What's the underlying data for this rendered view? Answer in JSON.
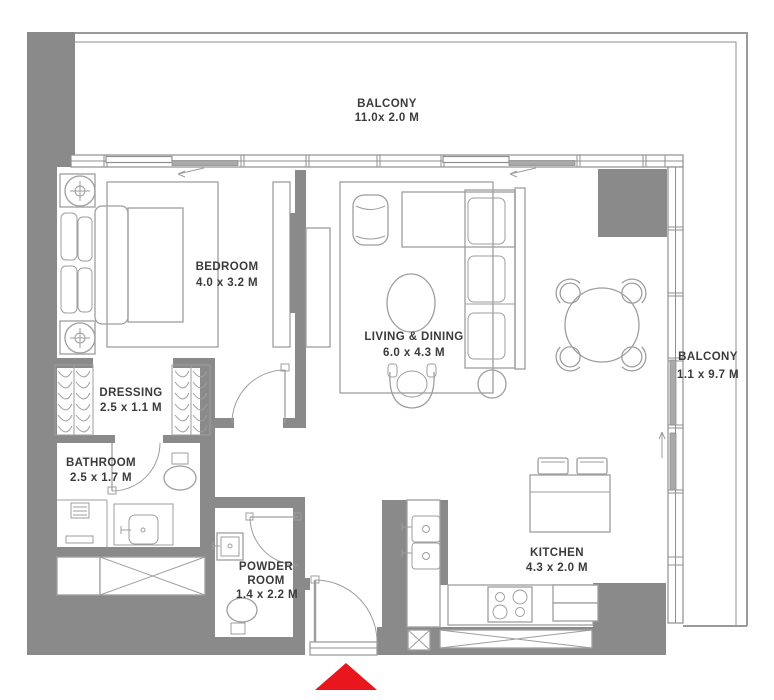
{
  "plan": {
    "type": "apartment-floor-plan",
    "rooms": {
      "balcony_top": {
        "name": "BALCONY",
        "dims": "11.0x 2.0 M"
      },
      "bedroom": {
        "name": "BEDROOM",
        "dims": "4.0 x 3.2 M"
      },
      "living_dining": {
        "name": "LIVING & DINING",
        "dims": "6.0 x 4.3 M"
      },
      "balcony_right": {
        "name": "BALCONY",
        "dims": "1.1 x 9.7 M"
      },
      "dressing": {
        "name": "DRESSING",
        "dims": "2.5 x 1.1 M"
      },
      "bathroom": {
        "name": "BATHROOM",
        "dims": "2.5 x 1.7 M"
      },
      "powder_room": {
        "name_line1": "POWDER",
        "name_line2": "ROOM",
        "dims": "1.4 x 2.2 M"
      },
      "kitchen": {
        "name": "KITCHEN",
        "dims": "4.3 x 2.0 M"
      }
    },
    "colors": {
      "wall": "#8a8a8a",
      "furniture_line": "#9e9e9e",
      "window_line": "#8f8f8f",
      "text": "#3b3b3b",
      "sliding_panel": "#a9a9a9",
      "entrance_marker": "#e9161d",
      "background": "#ffffff"
    }
  }
}
